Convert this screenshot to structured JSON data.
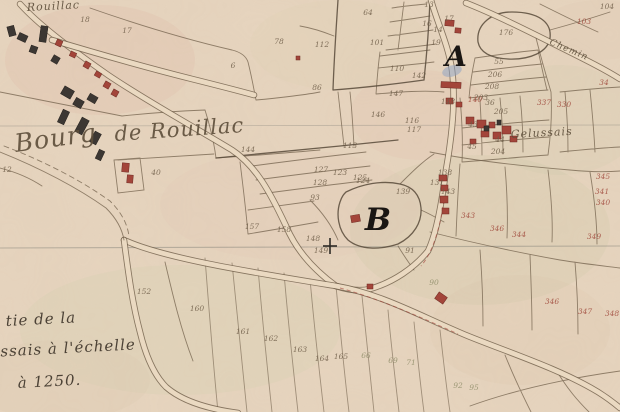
{
  "colors": {
    "paper": "#e7d5bf",
    "ink_sepia": "#6f5e49",
    "ink_red": "#9c4134",
    "ink_olive": "#85855f",
    "building_red": "#a3453a",
    "building_dark": "#3c3733",
    "watercolor_blue": "#8aa0c4"
  },
  "map": {
    "place_labels": [
      {
        "id": "rouillac-top",
        "text": "Rouillac",
        "x": 27,
        "y": 11,
        "size": 11,
        "rotate": -3
      },
      {
        "id": "bourg",
        "text": "Bourg",
        "x": 16,
        "y": 152,
        "size": 25,
        "rotate": -8
      },
      {
        "id": "de-rouillac",
        "text": "de Rouillac",
        "x": 115,
        "y": 141,
        "size": 21,
        "rotate": -4
      },
      {
        "id": "gelussais",
        "text": "Gelussais",
        "x": 511,
        "y": 138,
        "size": 11,
        "rotate": -3
      },
      {
        "id": "chemin",
        "text": "Chemin",
        "x": 549,
        "y": 44,
        "size": 9,
        "rotate": 23
      }
    ],
    "markers": [
      {
        "letter": "A",
        "x": 456,
        "y": 66,
        "size": 28
      },
      {
        "letter": "B",
        "x": 378,
        "y": 230,
        "size": 31
      }
    ],
    "legend_lines": [
      {
        "text": "tie de la",
        "x": 6,
        "y": 326
      },
      {
        "text": "ussais à l'échelle",
        "x": -10,
        "y": 357
      },
      {
        "text": "à 1250.",
        "x": 18,
        "y": 388
      }
    ],
    "parcel_numbers": [
      {
        "n": "18",
        "x": 85,
        "y": 22
      },
      {
        "n": "17",
        "x": 127,
        "y": 33
      },
      {
        "n": "78",
        "x": 279,
        "y": 44
      },
      {
        "n": "6",
        "x": 233,
        "y": 68
      },
      {
        "n": "12",
        "x": 7,
        "y": 172
      },
      {
        "n": "40",
        "x": 156,
        "y": 175
      },
      {
        "n": "64",
        "x": 368,
        "y": 15
      },
      {
        "n": "13",
        "x": 429,
        "y": 7
      },
      {
        "n": "16",
        "x": 427,
        "y": 26
      },
      {
        "n": "17",
        "x": 449,
        "y": 21
      },
      {
        "n": "14",
        "x": 438,
        "y": 32
      },
      {
        "n": "19",
        "x": 436,
        "y": 45
      },
      {
        "n": "101",
        "x": 377,
        "y": 45
      },
      {
        "n": "112",
        "x": 322,
        "y": 47
      },
      {
        "n": "86",
        "x": 317,
        "y": 90
      },
      {
        "n": "110",
        "x": 397,
        "y": 71
      },
      {
        "n": "142",
        "x": 419,
        "y": 78
      },
      {
        "n": "104",
        "x": 607,
        "y": 9
      },
      {
        "n": "103",
        "x": 584,
        "y": 24,
        "c": "r"
      },
      {
        "n": "176",
        "x": 506,
        "y": 35
      },
      {
        "n": "55",
        "x": 499,
        "y": 64
      },
      {
        "n": "206",
        "x": 495,
        "y": 77
      },
      {
        "n": "208",
        "x": 492,
        "y": 89
      },
      {
        "n": "203",
        "x": 481,
        "y": 100
      },
      {
        "n": "34",
        "x": 604,
        "y": 85,
        "c": "r"
      },
      {
        "n": "337",
        "x": 544,
        "y": 105,
        "c": "r"
      },
      {
        "n": "330",
        "x": 564,
        "y": 107,
        "c": "r"
      },
      {
        "n": "147",
        "x": 396,
        "y": 96
      },
      {
        "n": "148",
        "x": 448,
        "y": 104
      },
      {
        "n": "140",
        "x": 475,
        "y": 102,
        "c": "r"
      },
      {
        "n": "36",
        "x": 490,
        "y": 105
      },
      {
        "n": "205",
        "x": 501,
        "y": 114
      },
      {
        "n": "116",
        "x": 412,
        "y": 123
      },
      {
        "n": "117",
        "x": 414,
        "y": 132
      },
      {
        "n": "43",
        "x": 473,
        "y": 127
      },
      {
        "n": "44",
        "x": 500,
        "y": 142
      },
      {
        "n": "45",
        "x": 472,
        "y": 149
      },
      {
        "n": "204",
        "x": 498,
        "y": 154
      },
      {
        "n": "144",
        "x": 248,
        "y": 152
      },
      {
        "n": "113",
        "x": 350,
        "y": 148
      },
      {
        "n": "146",
        "x": 378,
        "y": 117
      },
      {
        "n": "123",
        "x": 340,
        "y": 175
      },
      {
        "n": "125",
        "x": 360,
        "y": 180
      },
      {
        "n": "127",
        "x": 321,
        "y": 172
      },
      {
        "n": "128",
        "x": 320,
        "y": 185
      },
      {
        "n": "93",
        "x": 315,
        "y": 200
      },
      {
        "n": "124",
        "x": 363,
        "y": 183
      },
      {
        "n": "131",
        "x": 437,
        "y": 185
      },
      {
        "n": "138",
        "x": 445,
        "y": 175
      },
      {
        "n": "139",
        "x": 403,
        "y": 194
      },
      {
        "n": "143",
        "x": 448,
        "y": 194
      },
      {
        "n": "157",
        "x": 252,
        "y": 229
      },
      {
        "n": "158",
        "x": 284,
        "y": 232
      },
      {
        "n": "148",
        "x": 313,
        "y": 241
      },
      {
        "n": "149",
        "x": 321,
        "y": 253
      },
      {
        "n": "91",
        "x": 410,
        "y": 253
      },
      {
        "n": "152",
        "x": 144,
        "y": 294
      },
      {
        "n": "160",
        "x": 197,
        "y": 311
      },
      {
        "n": "161",
        "x": 243,
        "y": 334
      },
      {
        "n": "162",
        "x": 271,
        "y": 341
      },
      {
        "n": "163",
        "x": 300,
        "y": 352
      },
      {
        "n": "164",
        "x": 322,
        "y": 361
      },
      {
        "n": "165",
        "x": 341,
        "y": 359
      },
      {
        "n": "66",
        "x": 366,
        "y": 358,
        "c": "g"
      },
      {
        "n": "69",
        "x": 393,
        "y": 363,
        "c": "g"
      },
      {
        "n": "71",
        "x": 411,
        "y": 365,
        "c": "g"
      },
      {
        "n": "92",
        "x": 458,
        "y": 388,
        "c": "g"
      },
      {
        "n": "95",
        "x": 474,
        "y": 390,
        "c": "g"
      },
      {
        "n": "90",
        "x": 434,
        "y": 285,
        "c": "g"
      },
      {
        "n": "345",
        "x": 603,
        "y": 179,
        "c": "r"
      },
      {
        "n": "341",
        "x": 602,
        "y": 194,
        "c": "r"
      },
      {
        "n": "340",
        "x": 603,
        "y": 205,
        "c": "r"
      },
      {
        "n": "343",
        "x": 468,
        "y": 218,
        "c": "r"
      },
      {
        "n": "346",
        "x": 497,
        "y": 231,
        "c": "r"
      },
      {
        "n": "344",
        "x": 519,
        "y": 237,
        "c": "r"
      },
      {
        "n": "349",
        "x": 594,
        "y": 239,
        "c": "r"
      },
      {
        "n": "346",
        "x": 552,
        "y": 304,
        "c": "r"
      },
      {
        "n": "347",
        "x": 585,
        "y": 314,
        "c": "r"
      },
      {
        "n": "348",
        "x": 612,
        "y": 316,
        "c": "r"
      }
    ],
    "buildings": [
      {
        "x": 8,
        "y": 26,
        "w": 7,
        "h": 10,
        "r": -15,
        "c": "k"
      },
      {
        "x": 18,
        "y": 34,
        "w": 9,
        "h": 7,
        "r": 25,
        "c": "k"
      },
      {
        "x": 40,
        "y": 26,
        "w": 7,
        "h": 16,
        "r": 8,
        "c": "k"
      },
      {
        "x": 30,
        "y": 46,
        "w": 7,
        "h": 7,
        "r": 20,
        "c": "k"
      },
      {
        "x": 52,
        "y": 56,
        "w": 7,
        "h": 7,
        "r": 30,
        "c": "k"
      },
      {
        "x": 62,
        "y": 88,
        "w": 11,
        "h": 9,
        "r": 30,
        "c": "k"
      },
      {
        "x": 74,
        "y": 99,
        "w": 9,
        "h": 8,
        "r": 30,
        "c": "k"
      },
      {
        "x": 60,
        "y": 110,
        "w": 7,
        "h": 14,
        "r": 25,
        "c": "k"
      },
      {
        "x": 88,
        "y": 95,
        "w": 9,
        "h": 7,
        "r": 30,
        "c": "k"
      },
      {
        "x": 78,
        "y": 118,
        "w": 8,
        "h": 16,
        "r": 28,
        "c": "k"
      },
      {
        "x": 92,
        "y": 132,
        "w": 7,
        "h": 12,
        "r": 28,
        "c": "k"
      },
      {
        "x": 97,
        "y": 150,
        "w": 6,
        "h": 10,
        "r": 25,
        "c": "k"
      },
      {
        "x": 56,
        "y": 40,
        "w": 6,
        "h": 6,
        "r": 25,
        "c": "r"
      },
      {
        "x": 70,
        "y": 52,
        "w": 6,
        "h": 5,
        "r": 25,
        "c": "r"
      },
      {
        "x": 84,
        "y": 62,
        "w": 6,
        "h": 6,
        "r": 30,
        "c": "r"
      },
      {
        "x": 95,
        "y": 72,
        "w": 6,
        "h": 5,
        "r": 30,
        "c": "r"
      },
      {
        "x": 104,
        "y": 82,
        "w": 6,
        "h": 6,
        "r": 30,
        "c": "r"
      },
      {
        "x": 112,
        "y": 90,
        "w": 6,
        "h": 6,
        "r": 30,
        "c": "r"
      },
      {
        "x": 122,
        "y": 163,
        "w": 7,
        "h": 9,
        "r": 5,
        "c": "r"
      },
      {
        "x": 127,
        "y": 175,
        "w": 6,
        "h": 8,
        "r": 5,
        "c": "r"
      },
      {
        "x": 296,
        "y": 56,
        "w": 4,
        "h": 4,
        "r": 0,
        "c": "r"
      },
      {
        "x": 445,
        "y": 20,
        "w": 9,
        "h": 6,
        "r": 5,
        "c": "r"
      },
      {
        "x": 455,
        "y": 28,
        "w": 6,
        "h": 5,
        "r": 5,
        "c": "r"
      },
      {
        "x": 441,
        "y": 82,
        "w": 20,
        "h": 6,
        "r": 3,
        "c": "r"
      },
      {
        "x": 446,
        "y": 98,
        "w": 7,
        "h": 6,
        "r": 0,
        "c": "r"
      },
      {
        "x": 456,
        "y": 102,
        "w": 6,
        "h": 5,
        "r": 0,
        "c": "r"
      },
      {
        "x": 466,
        "y": 117,
        "w": 8,
        "h": 7,
        "r": 0,
        "c": "r"
      },
      {
        "x": 477,
        "y": 120,
        "w": 9,
        "h": 8,
        "r": 0,
        "c": "r"
      },
      {
        "x": 489,
        "y": 122,
        "w": 6,
        "h": 6,
        "r": 0,
        "c": "r"
      },
      {
        "x": 481,
        "y": 131,
        "w": 8,
        "h": 6,
        "r": 0,
        "c": "r"
      },
      {
        "x": 493,
        "y": 132,
        "w": 8,
        "h": 7,
        "r": 0,
        "c": "r"
      },
      {
        "x": 470,
        "y": 139,
        "w": 6,
        "h": 5,
        "r": 0,
        "c": "r"
      },
      {
        "x": 502,
        "y": 126,
        "w": 9,
        "h": 8,
        "r": 0,
        "c": "r"
      },
      {
        "x": 510,
        "y": 136,
        "w": 7,
        "h": 6,
        "r": 0,
        "c": "r"
      },
      {
        "x": 484,
        "y": 126,
        "w": 5,
        "h": 5,
        "r": 0,
        "c": "k"
      },
      {
        "x": 497,
        "y": 120,
        "w": 4,
        "h": 5,
        "r": 0,
        "c": "k"
      },
      {
        "x": 439,
        "y": 175,
        "w": 8,
        "h": 6,
        "r": 0,
        "c": "r"
      },
      {
        "x": 441,
        "y": 185,
        "w": 7,
        "h": 6,
        "r": 0,
        "c": "r"
      },
      {
        "x": 440,
        "y": 196,
        "w": 8,
        "h": 7,
        "r": 0,
        "c": "r"
      },
      {
        "x": 442,
        "y": 208,
        "w": 7,
        "h": 6,
        "r": 0,
        "c": "r"
      },
      {
        "x": 351,
        "y": 215,
        "w": 9,
        "h": 7,
        "r": -10,
        "c": "r"
      },
      {
        "x": 367,
        "y": 284,
        "w": 6,
        "h": 5,
        "r": 0,
        "c": "r"
      },
      {
        "x": 436,
        "y": 294,
        "w": 10,
        "h": 8,
        "r": 35,
        "c": "r"
      }
    ]
  }
}
